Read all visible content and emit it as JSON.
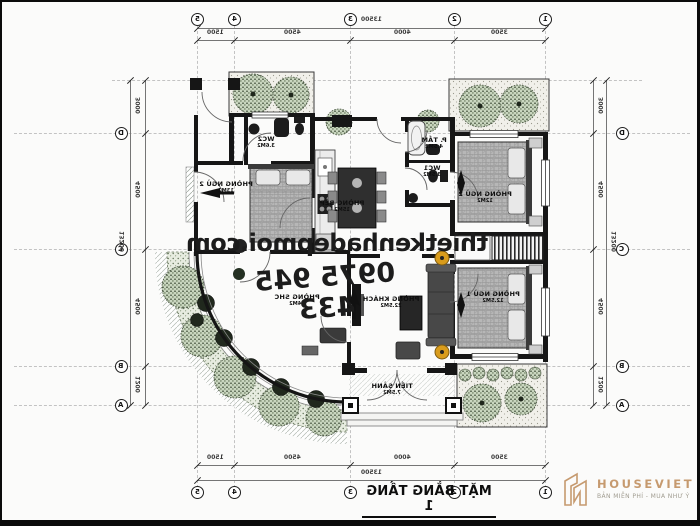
{
  "watermark": {
    "site": "thietkenhadepmoi.com",
    "phone": "0975 945 433"
  },
  "title_block": {
    "title": "MẶT BẰNG TẦNG 1",
    "subtitle": "TỔNG DIỆN TÍCH 139M2"
  },
  "logo": {
    "name": "HOUSEVIET",
    "tagline": "BẢN MIỄN PHÍ - MUA NHƯ Ý",
    "color": "#c69a6f"
  },
  "grid": {
    "cols": [
      {
        "label": "5",
        "x": 195
      },
      {
        "label": "4",
        "x": 232
      },
      {
        "label": "3",
        "x": 348
      },
      {
        "label": "2",
        "x": 452
      },
      {
        "label": "1",
        "x": 543
      }
    ],
    "rows": [
      {
        "label": "D",
        "y": 131
      },
      {
        "label": "C",
        "y": 247
      },
      {
        "label": "B",
        "y": 364
      },
      {
        "label": "A",
        "y": 403
      }
    ],
    "aux_row_y": 78,
    "bubble_top_y": 17,
    "bubble_bottom_y": 490,
    "bubble_left_x": 119,
    "bubble_right_x": 620
  },
  "dims": {
    "top": {
      "overall": "13500",
      "segments": [
        "1500",
        "4500",
        "4000",
        "3500"
      ]
    },
    "bottom": {
      "overall": "13500",
      "segments": [
        "1500",
        "4500",
        "4000",
        "3500"
      ]
    },
    "left": {
      "overall": "13200",
      "segments": [
        "3000",
        "4500",
        "4500",
        "1200"
      ],
      "ticks": [
        78,
        131,
        247,
        364,
        403
      ]
    },
    "right": {
      "overall": "13200",
      "segments": [
        "3000",
        "4500",
        "4500",
        "1200"
      ],
      "ticks": [
        78,
        131,
        247,
        364,
        403
      ]
    }
  },
  "rooms": [
    {
      "name": "WC2",
      "area": "3.6M2",
      "x": 264,
      "y": 141
    },
    {
      "name": "PHÒNG NGỦ 2",
      "area": "13M2",
      "x": 224,
      "y": 186
    },
    {
      "name": "PHÒNG BẾP",
      "area": "15M2",
      "x": 340,
      "y": 205
    },
    {
      "name": "P. TẮM",
      "area": "4.5M2",
      "x": 432,
      "y": 142
    },
    {
      "name": "WC1",
      "area": "3.5M2",
      "x": 430,
      "y": 170
    },
    {
      "name": "PHÒNG NGỦ 2",
      "area": "12M2",
      "x": 483,
      "y": 196
    },
    {
      "name": "PHÒNG KHÁCH",
      "area": "22.5M2",
      "x": 389,
      "y": 301
    },
    {
      "name": "PHÒNG NGỦ 1",
      "area": "12.5M2",
      "x": 491,
      "y": 296
    },
    {
      "name": "PHÒNG SHC",
      "area": "14M2",
      "x": 295,
      "y": 299
    },
    {
      "name": "TIỀN SẢNH",
      "area": "7.5M2",
      "x": 390,
      "y": 388
    }
  ]
}
